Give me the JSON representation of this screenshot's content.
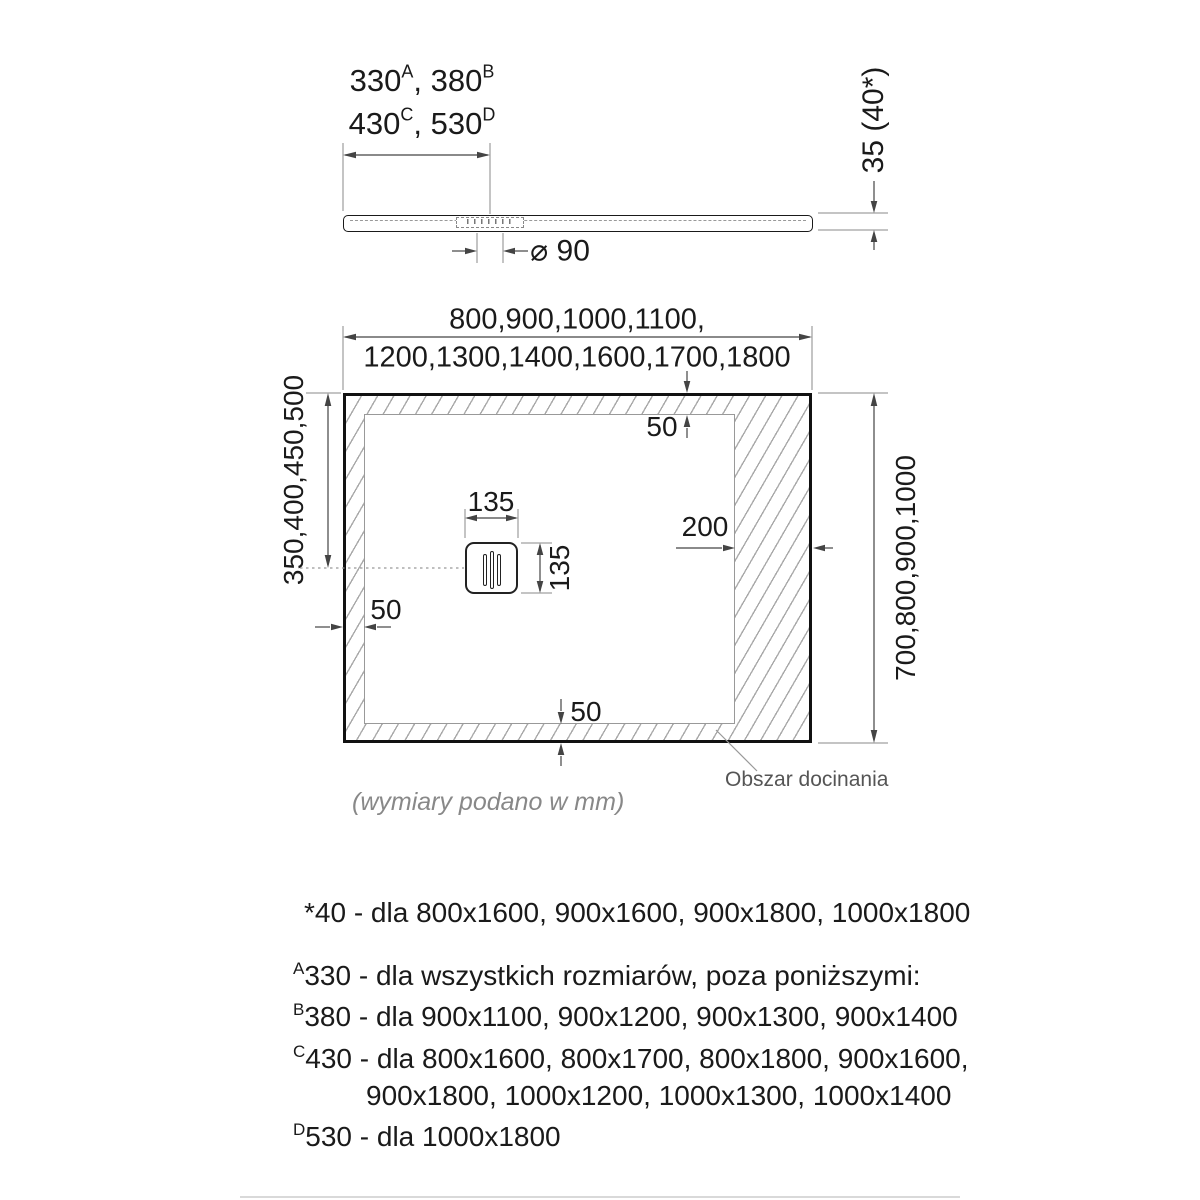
{
  "side_view": {
    "length": {
      "l1v1": "330",
      "l1s1": "A",
      "l1v2": ", 380",
      "l1s2": "B",
      "l2v1": "430",
      "l2s1": "C",
      "l2v2": ", 530",
      "l2s2": "D"
    },
    "thickness_label": "35 (40*)",
    "drain_diameter_label": "⌀ 90"
  },
  "plan_view": {
    "width_label_line1": "800,900,1000,1100,",
    "width_label_line2": "1200,1300,1400,1600,1700,1800",
    "depth_label": "350,400,450,500",
    "length_label_right": "700,800,900,1000",
    "drain_width": "135",
    "drain_height": "135",
    "trim_width": "200",
    "edge_top": "50",
    "edge_left": "50",
    "edge_bottom": "50",
    "trim_area_label": "Obszar docinania",
    "units_note": "(wymiary podano w mm)"
  },
  "notes": {
    "note_40": "*40 - dla 800x1600, 900x1600, 900x1800, 1000x1800",
    "note_a": {
      "sup": "A",
      "text": "330 - dla wszystkich rozmiarów, poza poniższymi:"
    },
    "note_b": {
      "sup": "B",
      "text": "380 - dla 900x1100, 900x1200, 900x1300, 900x1400"
    },
    "note_c": {
      "sup": "C",
      "text": "430 - dla 800x1600, 800x1700, 800x1800, 900x1600,"
    },
    "note_c_cont": "900x1800, 1000x1200, 1000x1300, 1000x1400",
    "note_d": {
      "sup": "D",
      "text": "530 - dla 1000x1800"
    }
  },
  "colors": {
    "line": "#1a1a1a",
    "dim_line": "#444444",
    "ext_line": "#888888",
    "hatch": "#a9a9a9",
    "muted_text": "#777777"
  }
}
